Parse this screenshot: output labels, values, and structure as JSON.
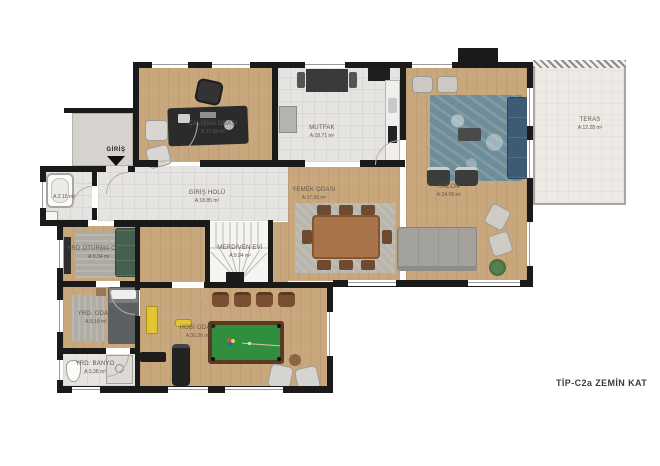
{
  "title": "TİP-C2a  ZEMİN KAT",
  "entrance": {
    "label": "GİRİŞ"
  },
  "rooms": {
    "calisma": {
      "name": "ÇALIŞMA ODASI",
      "area": "A:21.58 m²"
    },
    "mutfak": {
      "name": "MUTFAK",
      "area": "A:18.71 m²"
    },
    "salon": {
      "name": "SALON",
      "area": "A:34.58 m²"
    },
    "teras": {
      "name": "TERAS",
      "area": "A:12.28 m²"
    },
    "giris_holu": {
      "name": "GİRİŞ HOLÜ",
      "area": "A:18.85 m²"
    },
    "merdiven_evi": {
      "name": "MERDİVEN EVİ",
      "area": "A:9.94 m²"
    },
    "wc": {
      "area": "A:2.16 m²"
    },
    "yrd_oturma": {
      "name": "YRD.OTURMA ODASI",
      "area": "A:9.34 m²"
    },
    "yemek": {
      "name": "YEMEK ODASI",
      "area": "A:17.56 m²"
    },
    "yrd_odasi": {
      "name": "YRD. ODASI",
      "area": "A:9.18 m²"
    },
    "yrd_banyo": {
      "name": "YRD. BANYO",
      "area": "A:3.38 m²"
    },
    "hobi": {
      "name": "HOBİ ODASI",
      "area": "A:30.26 m²"
    }
  },
  "colors": {
    "wall": "#1a1a1a",
    "wood": "#c9a77c",
    "tile": "#e6e4e1",
    "terrace": "#edeae5",
    "pool_felt": "#2f8f3f",
    "sofa_blue": "#3e5a74",
    "sofa_green": "#45604d",
    "gym_yellow": "#e3c531",
    "label_text": "#5f584e"
  }
}
